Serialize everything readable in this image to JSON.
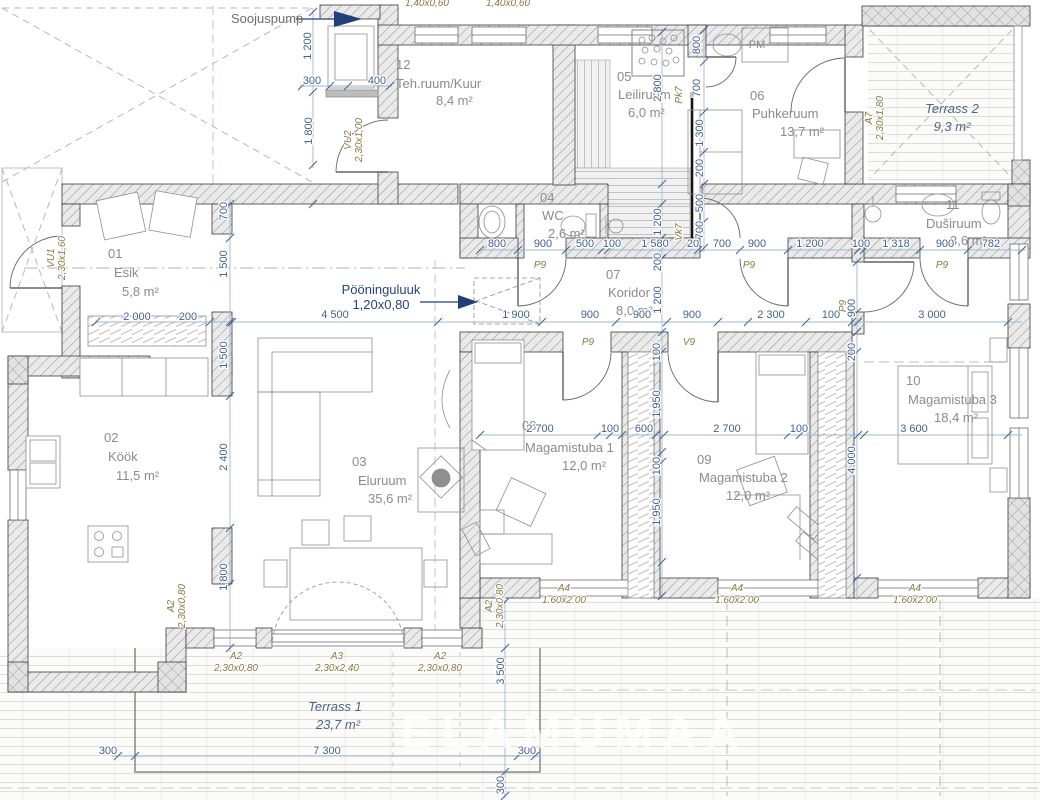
{
  "drawing": {
    "type": "floor-plan",
    "units": "mm",
    "accent_blue": "#27427c",
    "dim_color": "#44618f",
    "opening_color": "#8a7840",
    "room_color": "#8b8b8b"
  },
  "rooms": [
    {
      "num": "01",
      "name": "Esik",
      "area": "5,8 m²",
      "pos": {
        "num": [
          108,
          258
        ],
        "name": [
          114,
          277
        ],
        "area": [
          122,
          296
        ]
      }
    },
    {
      "num": "02",
      "name": "Köök",
      "area": "11,5 m²",
      "pos": {
        "num": [
          104,
          442
        ],
        "name": [
          108,
          461
        ],
        "area": [
          116,
          480
        ]
      }
    },
    {
      "num": "03",
      "name": "Eluruum",
      "area": "35,6 m²",
      "pos": {
        "num": [
          352,
          466
        ],
        "name": [
          358,
          485
        ],
        "area": [
          368,
          503
        ]
      }
    },
    {
      "num": "04",
      "name": "WC",
      "area": "2,6 m²",
      "pos": {
        "num": [
          540,
          202
        ],
        "name": [
          542,
          220
        ],
        "area": [
          548,
          238
        ]
      }
    },
    {
      "num": "05",
      "name": "Leiliruum",
      "area": "6,0 m²",
      "pos": {
        "num": [
          617,
          81
        ],
        "name": [
          618,
          99
        ],
        "area": [
          628,
          117
        ]
      }
    },
    {
      "num": "06",
      "name": "Puhkeruum",
      "area": "13,7 m²",
      "pos": {
        "num": [
          750,
          100
        ],
        "name": [
          752,
          118
        ],
        "area": [
          780,
          136
        ]
      }
    },
    {
      "num": "07",
      "name": "Koridor",
      "area": "8,0 m²",
      "pos": {
        "num": [
          606,
          279
        ],
        "name": [
          608,
          297
        ],
        "area": [
          616,
          315
        ]
      }
    },
    {
      "num": "08",
      "name": "Magamistuba 1",
      "area": "12,0 m²",
      "pos": {
        "num": [
          522,
          430
        ],
        "name": [
          525,
          452
        ],
        "area": [
          562,
          470
        ]
      }
    },
    {
      "num": "09",
      "name": "Magamistuba 2",
      "area": "12,0 m²",
      "pos": {
        "num": [
          697,
          464
        ],
        "name": [
          699,
          482
        ],
        "area": [
          726,
          500
        ]
      }
    },
    {
      "num": "10",
      "name": "Magamistuba 3",
      "area": "18,4 m²",
      "pos": {
        "num": [
          906,
          385
        ],
        "name": [
          908,
          404
        ],
        "area": [
          934,
          422
        ]
      }
    },
    {
      "num": "11",
      "name": "Duširuum",
      "area": "3,6 m²",
      "pos": {
        "num": [
          946,
          209
        ],
        "name": [
          926,
          228
        ],
        "area": [
          950,
          245
        ]
      }
    },
    {
      "num": "12",
      "name": "Teh.ruum/Kuur",
      "area": "8,4 m²",
      "pos": {
        "num": [
          396,
          69
        ],
        "name": [
          396,
          88
        ],
        "area": [
          436,
          105
        ]
      }
    }
  ],
  "terraces": [
    {
      "name": "Terrass 1",
      "area": "23,7 m²",
      "pos": {
        "name": [
          335,
          711
        ],
        "area": [
          338,
          729
        ]
      }
    },
    {
      "name": "Terrass 2",
      "area": "9,3 m²",
      "pos": {
        "name": [
          952,
          113
        ],
        "area": [
          952,
          131
        ]
      }
    }
  ],
  "dims": [
    {
      "t": "800",
      "x": 497,
      "y": 247
    },
    {
      "t": "900",
      "x": 543,
      "y": 247
    },
    {
      "t": "500",
      "x": 585,
      "y": 247
    },
    {
      "t": "100",
      "x": 612,
      "y": 247
    },
    {
      "t": "1 580",
      "x": 655,
      "y": 247
    },
    {
      "t": "20",
      "x": 693,
      "y": 247
    },
    {
      "t": "700",
      "x": 722,
      "y": 247
    },
    {
      "t": "900",
      "x": 757,
      "y": 247
    },
    {
      "t": "1 200",
      "x": 810,
      "y": 247
    },
    {
      "t": "100",
      "x": 861,
      "y": 247
    },
    {
      "t": "1 318",
      "x": 896,
      "y": 247
    },
    {
      "t": "900",
      "x": 945,
      "y": 247
    },
    {
      "t": "782",
      "x": 991,
      "y": 247
    },
    {
      "t": "4 500",
      "x": 335,
      "y": 318
    },
    {
      "t": "1 900",
      "x": 516,
      "y": 318
    },
    {
      "t": "900",
      "x": 590,
      "y": 318
    },
    {
      "t": "900",
      "x": 642,
      "y": 318
    },
    {
      "t": "900",
      "x": 692,
      "y": 318
    },
    {
      "t": "2 300",
      "x": 771,
      "y": 318
    },
    {
      "t": "100",
      "x": 831,
      "y": 318
    },
    {
      "t": "3 000",
      "x": 932,
      "y": 318
    },
    {
      "t": "2 000",
      "x": 137,
      "y": 320
    },
    {
      "t": "200",
      "x": 188,
      "y": 320
    },
    {
      "t": "2 700",
      "x": 540,
      "y": 432
    },
    {
      "t": "100",
      "x": 610,
      "y": 432
    },
    {
      "t": "600",
      "x": 644,
      "y": 432
    },
    {
      "t": "2 700",
      "x": 727,
      "y": 432
    },
    {
      "t": "100",
      "x": 799,
      "y": 432
    },
    {
      "t": "3 600",
      "x": 914,
      "y": 432
    },
    {
      "t": "300",
      "x": 312,
      "y": 84
    },
    {
      "t": "400",
      "x": 377,
      "y": 84
    },
    {
      "t": "300",
      "x": 108,
      "y": 754
    },
    {
      "t": "7 300",
      "x": 327,
      "y": 754
    },
    {
      "t": "300",
      "x": 527,
      "y": 754
    },
    {
      "t": "1 200",
      "x": 311,
      "y": 46,
      "v": true
    },
    {
      "t": "1 800",
      "x": 312,
      "y": 131,
      "v": true
    },
    {
      "t": "700",
      "x": 227,
      "y": 211,
      "v": true
    },
    {
      "t": "1 500",
      "x": 227,
      "y": 264,
      "v": true
    },
    {
      "t": "1 500",
      "x": 227,
      "y": 355,
      "v": true
    },
    {
      "t": "2 400",
      "x": 227,
      "y": 457,
      "v": true
    },
    {
      "t": "1 800",
      "x": 227,
      "y": 577,
      "v": true
    },
    {
      "t": "2 800",
      "x": 661,
      "y": 88,
      "v": true
    },
    {
      "t": "1 200",
      "x": 661,
      "y": 222,
      "v": true
    },
    {
      "t": "200",
      "x": 661,
      "y": 262,
      "v": true
    },
    {
      "t": "1 200",
      "x": 661,
      "y": 300,
      "v": true
    },
    {
      "t": "100",
      "x": 660,
      "y": 352,
      "v": true
    },
    {
      "t": "1 950",
      "x": 660,
      "y": 404,
      "v": true
    },
    {
      "t": "100",
      "x": 660,
      "y": 466,
      "v": true
    },
    {
      "t": "1 950",
      "x": 660,
      "y": 512,
      "v": true
    },
    {
      "t": "800",
      "x": 700,
      "y": 45,
      "v": true
    },
    {
      "t": "700",
      "x": 700,
      "y": 88,
      "v": true
    },
    {
      "t": "1 300",
      "x": 703,
      "y": 133,
      "v": true
    },
    {
      "t": "200",
      "x": 703,
      "y": 168,
      "v": true
    },
    {
      "t": "500",
      "x": 703,
      "y": 203,
      "v": true
    },
    {
      "t": "700",
      "x": 703,
      "y": 230,
      "v": true
    },
    {
      "t": "900",
      "x": 855,
      "y": 308,
      "v": true
    },
    {
      "t": "200",
      "x": 855,
      "y": 352,
      "v": true
    },
    {
      "t": "4 000",
      "x": 855,
      "y": 460,
      "v": true
    },
    {
      "t": "3 500",
      "x": 504,
      "y": 671,
      "v": true
    },
    {
      "t": "300",
      "x": 504,
      "y": 785,
      "v": true
    }
  ],
  "openings": [
    {
      "lines": [
        "VU2",
        "2,30x1,00"
      ],
      "x": 351,
      "y": 140,
      "v": true
    },
    {
      "lines": [
        "VU1",
        "2,30x1,60"
      ],
      "x": 54,
      "y": 258,
      "v": true
    },
    {
      "lines": [
        "A7",
        "2,30x1,80"
      ],
      "x": 872,
      "y": 118,
      "v": true
    },
    {
      "lines": [
        "A2",
        "2,30x0,80"
      ],
      "x": 174,
      "y": 606,
      "v": true
    },
    {
      "lines": [
        "A2",
        "2,30x0,80"
      ],
      "x": 492,
      "y": 606,
      "v": true
    },
    {
      "lines": [
        "A2",
        "2,30x0,80"
      ],
      "x": 236,
      "y": 659
    },
    {
      "lines": [
        "A3",
        "2,30x2,40"
      ],
      "x": 337,
      "y": 659
    },
    {
      "lines": [
        "A2",
        "2,30x0,80"
      ],
      "x": 440,
      "y": 659
    },
    {
      "lines": [
        "A4",
        "1.60x2.00"
      ],
      "x": 564,
      "y": 591
    },
    {
      "lines": [
        "A4",
        "1.60x2.00"
      ],
      "x": 737,
      "y": 591
    },
    {
      "lines": [
        "A4",
        "1.60x2.00"
      ],
      "x": 915,
      "y": 591
    },
    {
      "lines": [
        "P9"
      ],
      "x": 540,
      "y": 268
    },
    {
      "lines": [
        "P9"
      ],
      "x": 749,
      "y": 268
    },
    {
      "lines": [
        "P9"
      ],
      "x": 942,
      "y": 268
    },
    {
      "lines": [
        "P9"
      ],
      "x": 588,
      "y": 345
    },
    {
      "lines": [
        "V9"
      ],
      "x": 689,
      "y": 345
    },
    {
      "lines": [
        "P9"
      ],
      "x": 846,
      "y": 306,
      "v": true
    },
    {
      "lines": [
        "Vk7"
      ],
      "x": 682,
      "y": 232,
      "v": true
    },
    {
      "lines": [
        "Pk7"
      ],
      "x": 682,
      "y": 95,
      "v": true
    }
  ],
  "top_labels": [
    {
      "t": "1,40x0,60",
      "x": 427,
      "y": 6
    },
    {
      "t": "1,40x0,60",
      "x": 508,
      "y": 6
    }
  ],
  "annotations": {
    "soojuspump": {
      "t": "Soojuspump",
      "x": 231,
      "y": 23
    },
    "attic": {
      "l1": "Pööninguluuk",
      "l2": "1,20x0,80",
      "x": 381,
      "y": 294
    },
    "pm": {
      "t": "PM",
      "x": 757,
      "y": 48
    },
    "watermark": {
      "t": "ELAMUMAA",
      "x": 575,
      "y": 748
    }
  }
}
